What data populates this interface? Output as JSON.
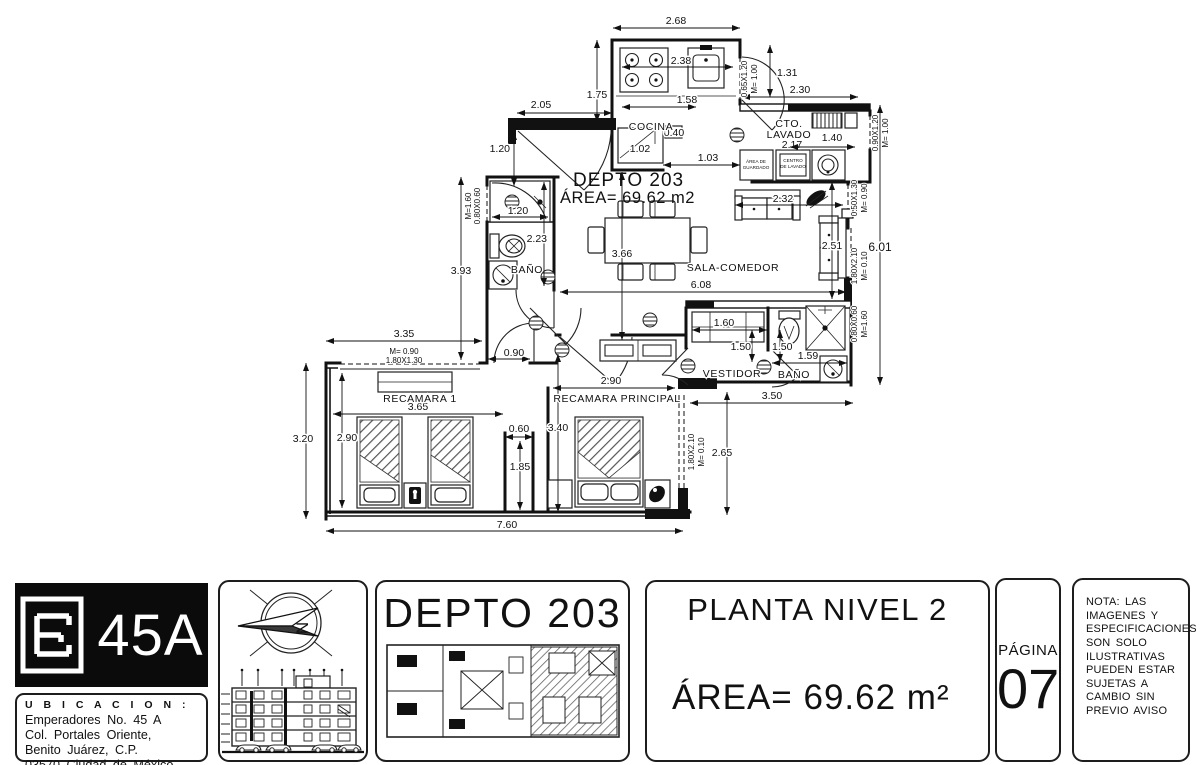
{
  "plan": {
    "title": "DEPTO 203",
    "area": "ÁREA= 69.62 m2",
    "rooms": {
      "cocina": "COCINA",
      "cto_a": "CTO.",
      "cto_b": "LAVADO",
      "sala": "SALA-COMEDOR",
      "bano1": "BAÑO",
      "rec1": "RECAMARA 1",
      "recp": "RECAMARA PRINCIPAL",
      "vestidor": "VESTIDOR",
      "bano2": "BAÑO",
      "guard_a": "ÁREA DE",
      "guard_b": "GUARDADO",
      "centro_a": "CENTRO",
      "centro_b": "DE LAVADO"
    },
    "dims": {
      "top": "2.68",
      "stove": "2.38",
      "kitchen_w": "1.58",
      "k_left": "1.75",
      "entry": "2.05",
      "entry_h": "1.20",
      "lavado_gap": "1.31",
      "lavado_top": "2.30",
      "lavado_w": "2.17",
      "closet_lav": "1.40",
      "fridge": "1.02",
      "mini": "0.40",
      "pass": "1.03",
      "shower1": "1.20",
      "bath1_l": "2.23",
      "left_v": "3.93",
      "dining_v": "3.66",
      "living_w": "6.08",
      "sofa_a": "2.32",
      "sofa_b": "2.51",
      "right_v": "6.01",
      "r1_top": "3.35",
      "r1_door": "0.90",
      "r1_w": "3.65",
      "r1_h": "2.90",
      "left_outer": "3.20",
      "niche_w": "0.60",
      "niche_h": "1.85",
      "bottom": "7.60",
      "rp_w": "2.90",
      "rp_h": "3.40",
      "vest_closet": "1.60",
      "vest_d": "1.50",
      "bath2_d": "1.50",
      "bath2_w": "1.59",
      "terrace_w": "3.50",
      "terrace_d": "2.65"
    },
    "win": {
      "cocina_a": "0.65X1.20",
      "cocina_b": "M= 1.00",
      "lavado_a": "0.90X1.20",
      "lavado_b": "M= 1.00",
      "sala_a": "0.50X1.30",
      "sala_b": "M= 0.90",
      "balcon_a": "1.80X2.10",
      "balcon_b": "M= 0.10",
      "bano2_a": "0.80X0.60",
      "bano2_b": "M=1.60",
      "recp_a": "1.80X2.10",
      "recp_b": "M= 0.10",
      "bano1_a": "M=1.60",
      "bano1_b": "0.80X0.60",
      "closet_a": "M= 0.90",
      "closet_b": "1.80X1.30"
    }
  },
  "footer": {
    "logo_text": "45A",
    "compass_n": "N",
    "ubicacion": {
      "heading": "U B I C A C I O N :",
      "line1": "Emperadores No. 45 A",
      "line2": "Col. Portales Oriente,",
      "line3": "Benito Juárez, C.P.",
      "line4": "03570 Ciudad de México"
    },
    "unit_title": "DEPTO 203",
    "level_title": "PLANTA NIVEL 2",
    "level_area": "ÁREA= 69.62 m²",
    "page_label": "PÁGINA",
    "page_number": "07",
    "nota": {
      "l1": "NOTA: LAS",
      "l2": "IMAGENES Y",
      "l3": "ESPECIFICACIONES",
      "l4": "SON SOLO",
      "l5": "ILUSTRATIVAS",
      "l6": "PUEDEN ESTAR",
      "l7": "SUJETAS A",
      "l8": "CAMBIO SIN",
      "l9": "PREVIO AVISO"
    }
  }
}
